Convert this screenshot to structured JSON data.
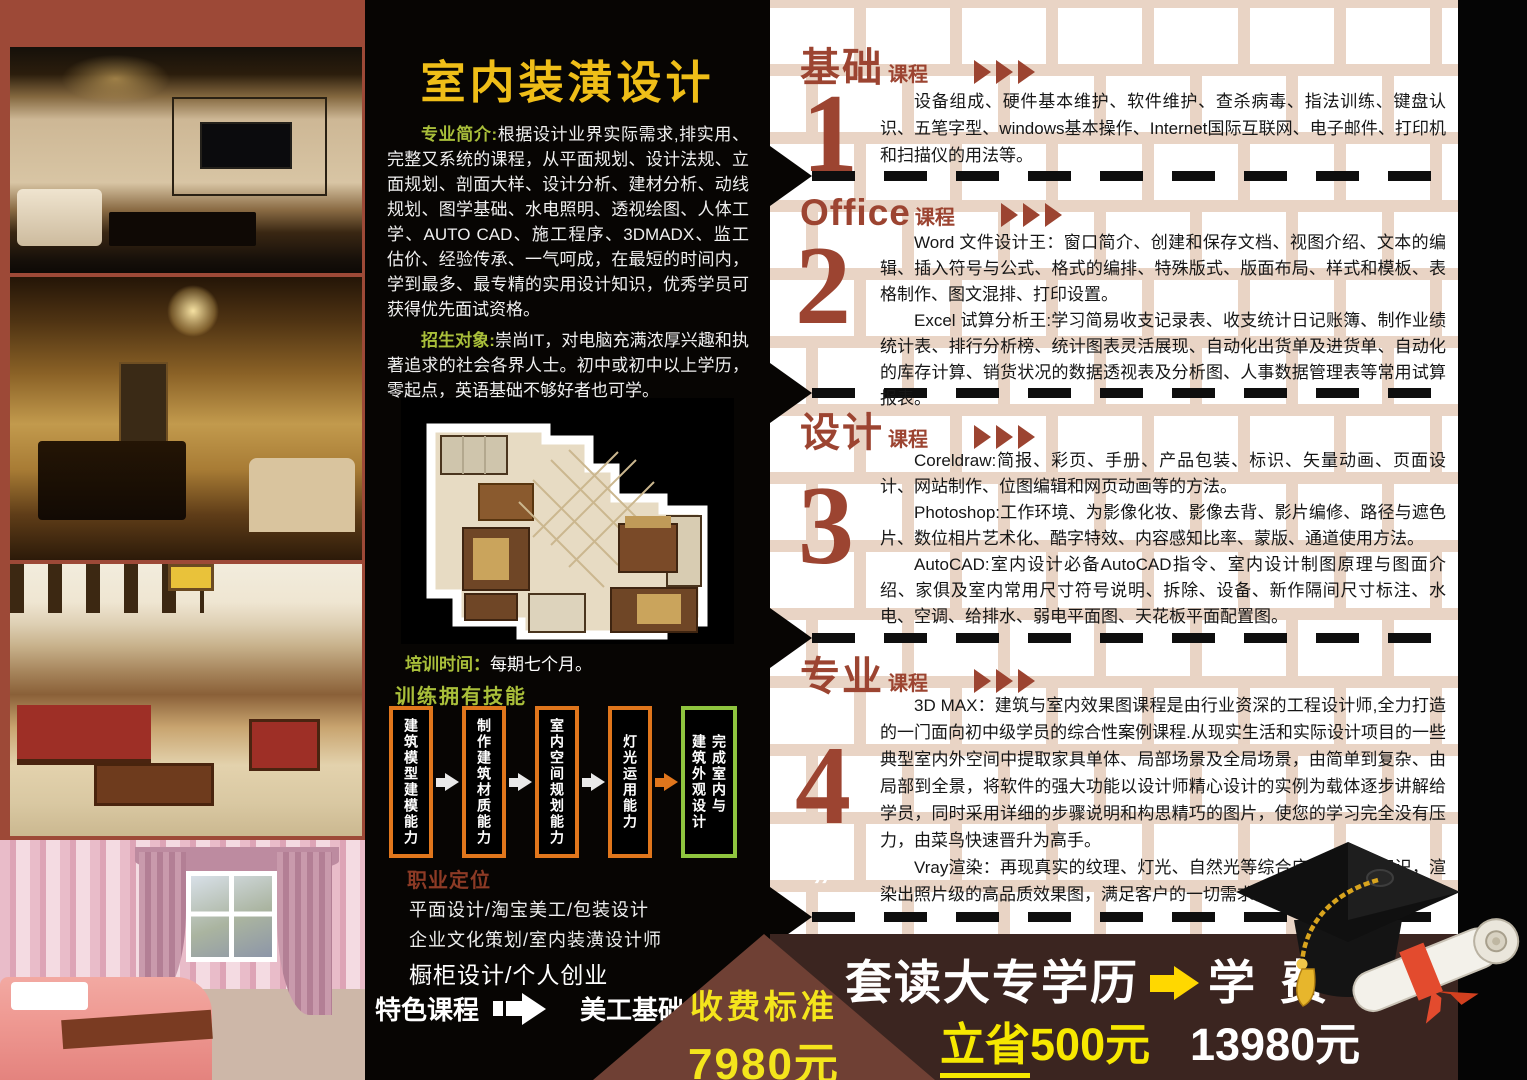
{
  "mid": {
    "title": "室内装潢设计",
    "intro_label": "专业简介:",
    "intro_text": "根据设计业界实际需求,排实用、完整又系统的课程，从平面规划、设计法规、立面规划、剖面大样、设计分析、建材分析、动线规划、图学基础、水电照明、透视绘图、人体工学、AUTO CAD、施工程序、3DMADX、监工估价、经验传承、一气呵成，在最短的时间内，学到最多、最专精的实用设计知识，优秀学员可获得优先面试资格。",
    "target_label": "招生对象:",
    "target_text": "崇尚IT，对电脑充满浓厚兴趣和执著追求的社会各界人士。初中或初中以上学历，零起点，英语基础不够好者也可学。",
    "duration_label": "培训时间：",
    "duration_text": "每期七个月。",
    "skills_title": "训练拥有技能",
    "skills": [
      "建筑模型建模能力",
      "制作建筑材质能力",
      "室内空间规划能力",
      "灯光运用能力",
      "完成室内与\n建筑外观设计"
    ],
    "career_title": "职业定位",
    "career_lines": [
      "平面设计/淘宝美工/包装设计",
      "企业文化策划/室内装潢设计师",
      "橱柜设计/个人创业"
    ],
    "feature_label": "特色课程",
    "feature_target": "美工基础"
  },
  "courses": [
    {
      "number": "1",
      "title": "基础",
      "suffix": "课程",
      "paragraphs": [
        "设备组成、硬件基本维护、软件维护、查杀病毒、指法训练、键盘认识、五笔字型、windows基本操作、Internet国际互联网、电子邮件、打印机和扫描仪的用法等。"
      ]
    },
    {
      "number": "2",
      "title": "Office",
      "suffix": "课程",
      "paragraphs": [
        "Word 文件设计王：窗口简介、创建和保存文档、视图介绍、文本的编辑、插入符号与公式、格式的编排、特殊版式、版面布局、样式和模板、表格制作、图文混排、打印设置。",
        "Excel 试算分析王:学习简易收支记录表、收支统计日记账簿、制作业绩统计表、排行分析榜、统计图表灵活展现、自动化出货单及进货单、自动化的库存计算、销货状况的数据透视表及分析图、人事数据管理表等常用试算报表。"
      ]
    },
    {
      "number": "3",
      "title": "设计",
      "suffix": "课程",
      "paragraphs": [
        "Coreldraw:简报、彩页、手册、产品包装、标识、矢量动画、页面设计、网站制作、位图编辑和网页动画等的方法。",
        "Photoshop:工作环境、为影像化妆、影像去背、影片编修、路径与遮色片、数位相片艺术化、酷字特效、内容感知比率、蒙版、通道使用方法。",
        "AutoCAD:室内设计必备AutoCAD指令、室内设计制图原理与图面介绍、家俱及室内常用尺寸符号说明、拆除、设备、新作隔间尺寸标注、水电、空调、给排水、弱电平面图、天花板平面配置图。"
      ]
    },
    {
      "number": "4",
      "title": "专业",
      "suffix": "课程",
      "paragraphs": [
        "3D MAX：建筑与室内效果图课程是由行业资深的工程设计师,全力打造的一门面向初中级学员的综合性案例课程.从现实生活和实际设计项目的一些典型室内外空间中提取家具单体、局部场景及全局场景，由简单到复杂、由局部到全景，将软件的强大功能以设计师精心设计的实例为载体逐步讲解给学员，同时采用详细的步骤说明和构思精巧的图片，使您的学习完全没有压力，由菜鸟快速晋升为高手。",
        "Vray渲染：再现真实的纹理、灯光、自然光等综合应用所学的知识，渲染出照片级的高品质效果图，满足客户的一切需求。"
      ]
    }
  ],
  "footer": {
    "fee_label": "收费标准",
    "fee_value": "7980元",
    "promo_title": "套读大专学历",
    "tuition_label": "学 费",
    "save_prefix": "立省",
    "save_suffix": "500元",
    "tuition_value": "13980元",
    "decor_mark": "”"
  },
  "colors": {
    "accent_red": "#9c4431",
    "title_yellow": "#efbe18",
    "label_green": "#a9bf3a",
    "footer_yellow": "#f7e800",
    "brick_mortar": "#e9d4c5",
    "photo_frame_maroon": "#9d4937",
    "bottom_brown": "#3b2520",
    "fee_triangle_brown": "#6f4034"
  }
}
